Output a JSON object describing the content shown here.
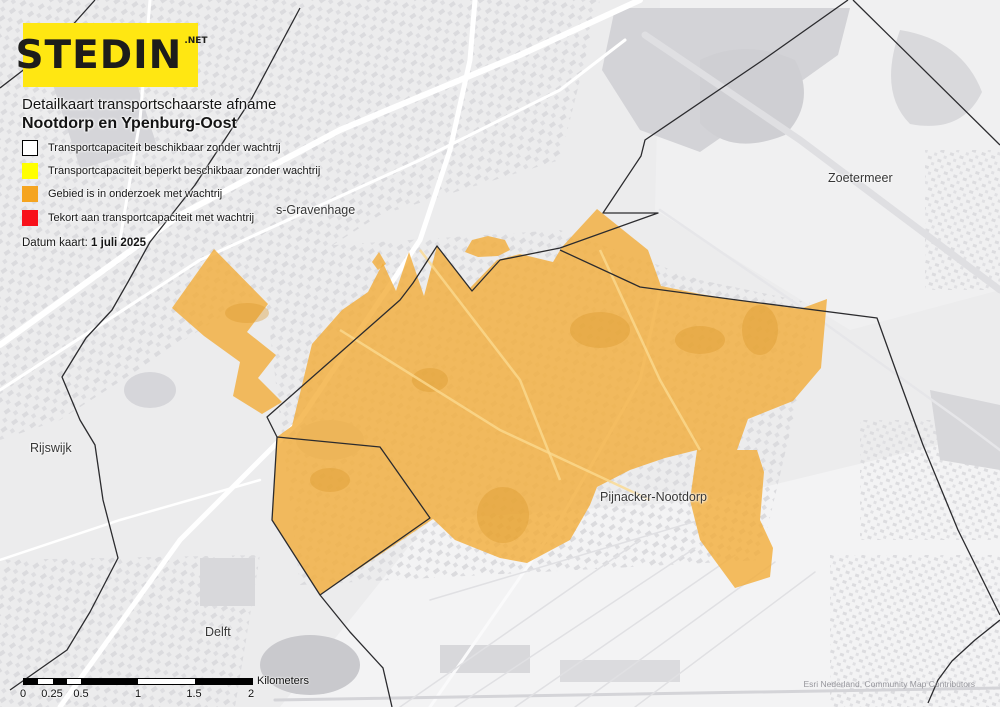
{
  "logo": {
    "text": "STEDIN",
    "suffix": ".NET"
  },
  "title": {
    "line1": "Detailkaart transportschaarste afname",
    "line2": "Nootdorp en Ypenburg-Oost"
  },
  "legend": {
    "items": [
      {
        "label": "Transportcapaciteit beschikbaar zonder wachtrij",
        "color": "#FFFFFF"
      },
      {
        "label": "Transportcapaciteit beperkt beschikbaar zonder wachtrij",
        "color": "#FFFF00"
      },
      {
        "label": "Gebied is in onderzoek met wachtrij",
        "color": "#F5A41F"
      },
      {
        "label": "Tekort aan transportcapaciteit met wachtrij",
        "color": "#F8101A"
      }
    ]
  },
  "map_date": {
    "prefix": "Datum kaart: ",
    "value": "1 juli 2025"
  },
  "map": {
    "region_color": "#F2AC38",
    "labels": [
      {
        "text": "s-Gravenhage"
      },
      {
        "text": "Zoetermeer"
      },
      {
        "text": "Rijswijk"
      },
      {
        "text": "Pijnacker-Nootdorp"
      },
      {
        "text": "Delft"
      }
    ]
  },
  "scalebar": {
    "ticks": [
      "0",
      "0.25",
      "0.5",
      "1",
      "1.5",
      "2"
    ],
    "unit": "Kilometers"
  },
  "attribution": "Esri Nederland, Community Map Contributors"
}
